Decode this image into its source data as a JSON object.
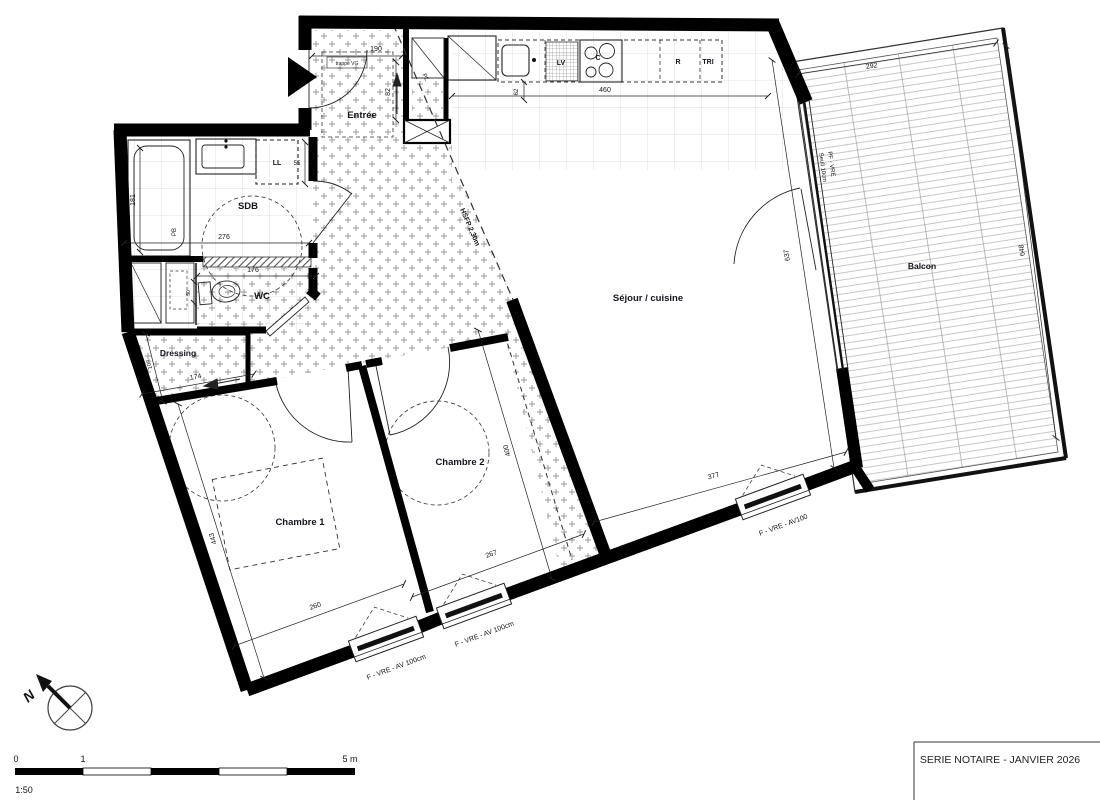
{
  "rooms": {
    "entree": "Entrée",
    "sdb": "SDB",
    "wc": "WC",
    "dressing": "Dressing",
    "chambre1": "Chambre 1",
    "chambre2": "Chambre 2",
    "sejour": "Séjour / cuisine",
    "balcon": "Balcon"
  },
  "kitchen": {
    "lv": "LV",
    "c": "C",
    "r": "R",
    "tri": "TRI"
  },
  "fixtures": {
    "ll": "LL",
    "pb": "PB",
    "pl": "PL",
    "trappe_vg": "trappe VG"
  },
  "annotations": {
    "hsfp": "HSFP 2,30m"
  },
  "windows": {
    "sejour": "F - VRE - AV100",
    "chambre2": "F - VRE - AV 100cm",
    "chambre1": "F - VRE - AV 100cm",
    "bay_type": "PF - VRE",
    "bay_seuil": "Seuil 10cm"
  },
  "dims": {
    "entree_width": "190",
    "entree_depth": "82",
    "kitchen_len": "460",
    "kitchen_depth": "62",
    "bath_len": "181",
    "sdb_width": "276",
    "ll_width": "55",
    "wc_width": "176",
    "wc_depth": "50",
    "dressing_len": "174",
    "dressing_depth": "108",
    "ch1_len": "443",
    "ch1_width": "260",
    "ch2_width": "267",
    "ch2_len": "400",
    "sejour_width": "377",
    "sejour_len": "637",
    "balcon_width": "292",
    "balcon_len": "648"
  },
  "title_block": {
    "title": "SERIE NOTAIRE - JANVIER 2026"
  },
  "scale_bar": {
    "ratio": "1:50",
    "tick0": "0",
    "tick1": "1",
    "tick5": "5 m"
  },
  "north": {
    "label": "N"
  },
  "colors": {
    "wall": "#000000",
    "hatch": "#9a9a9a",
    "tile": "#d6d6d6",
    "text": "#15151c"
  }
}
